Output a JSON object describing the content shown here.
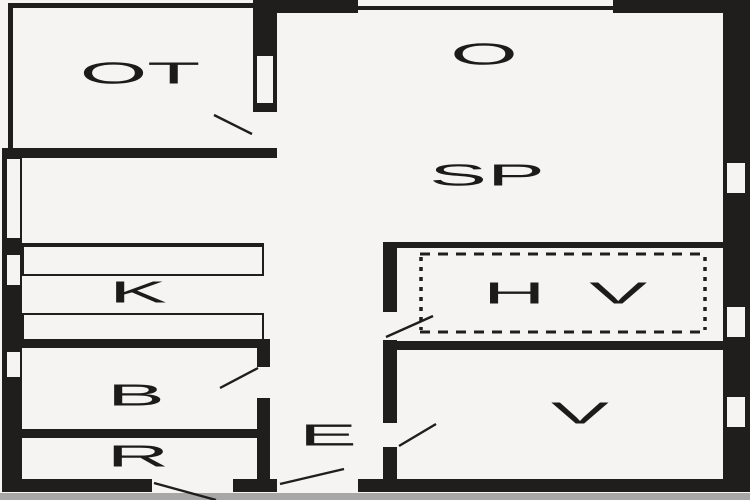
{
  "floorplan": {
    "rooms": {
      "ot": "OT",
      "o": "O",
      "sp": "SP",
      "k": "K",
      "b": "B",
      "r": "R",
      "e": "E",
      "hv": "H V",
      "v": "V"
    },
    "colors": {
      "wall": "#201e1c",
      "background": "#f6f4f2",
      "label": "#1d1b19",
      "bottom_strip": "#a8a7a5"
    }
  }
}
